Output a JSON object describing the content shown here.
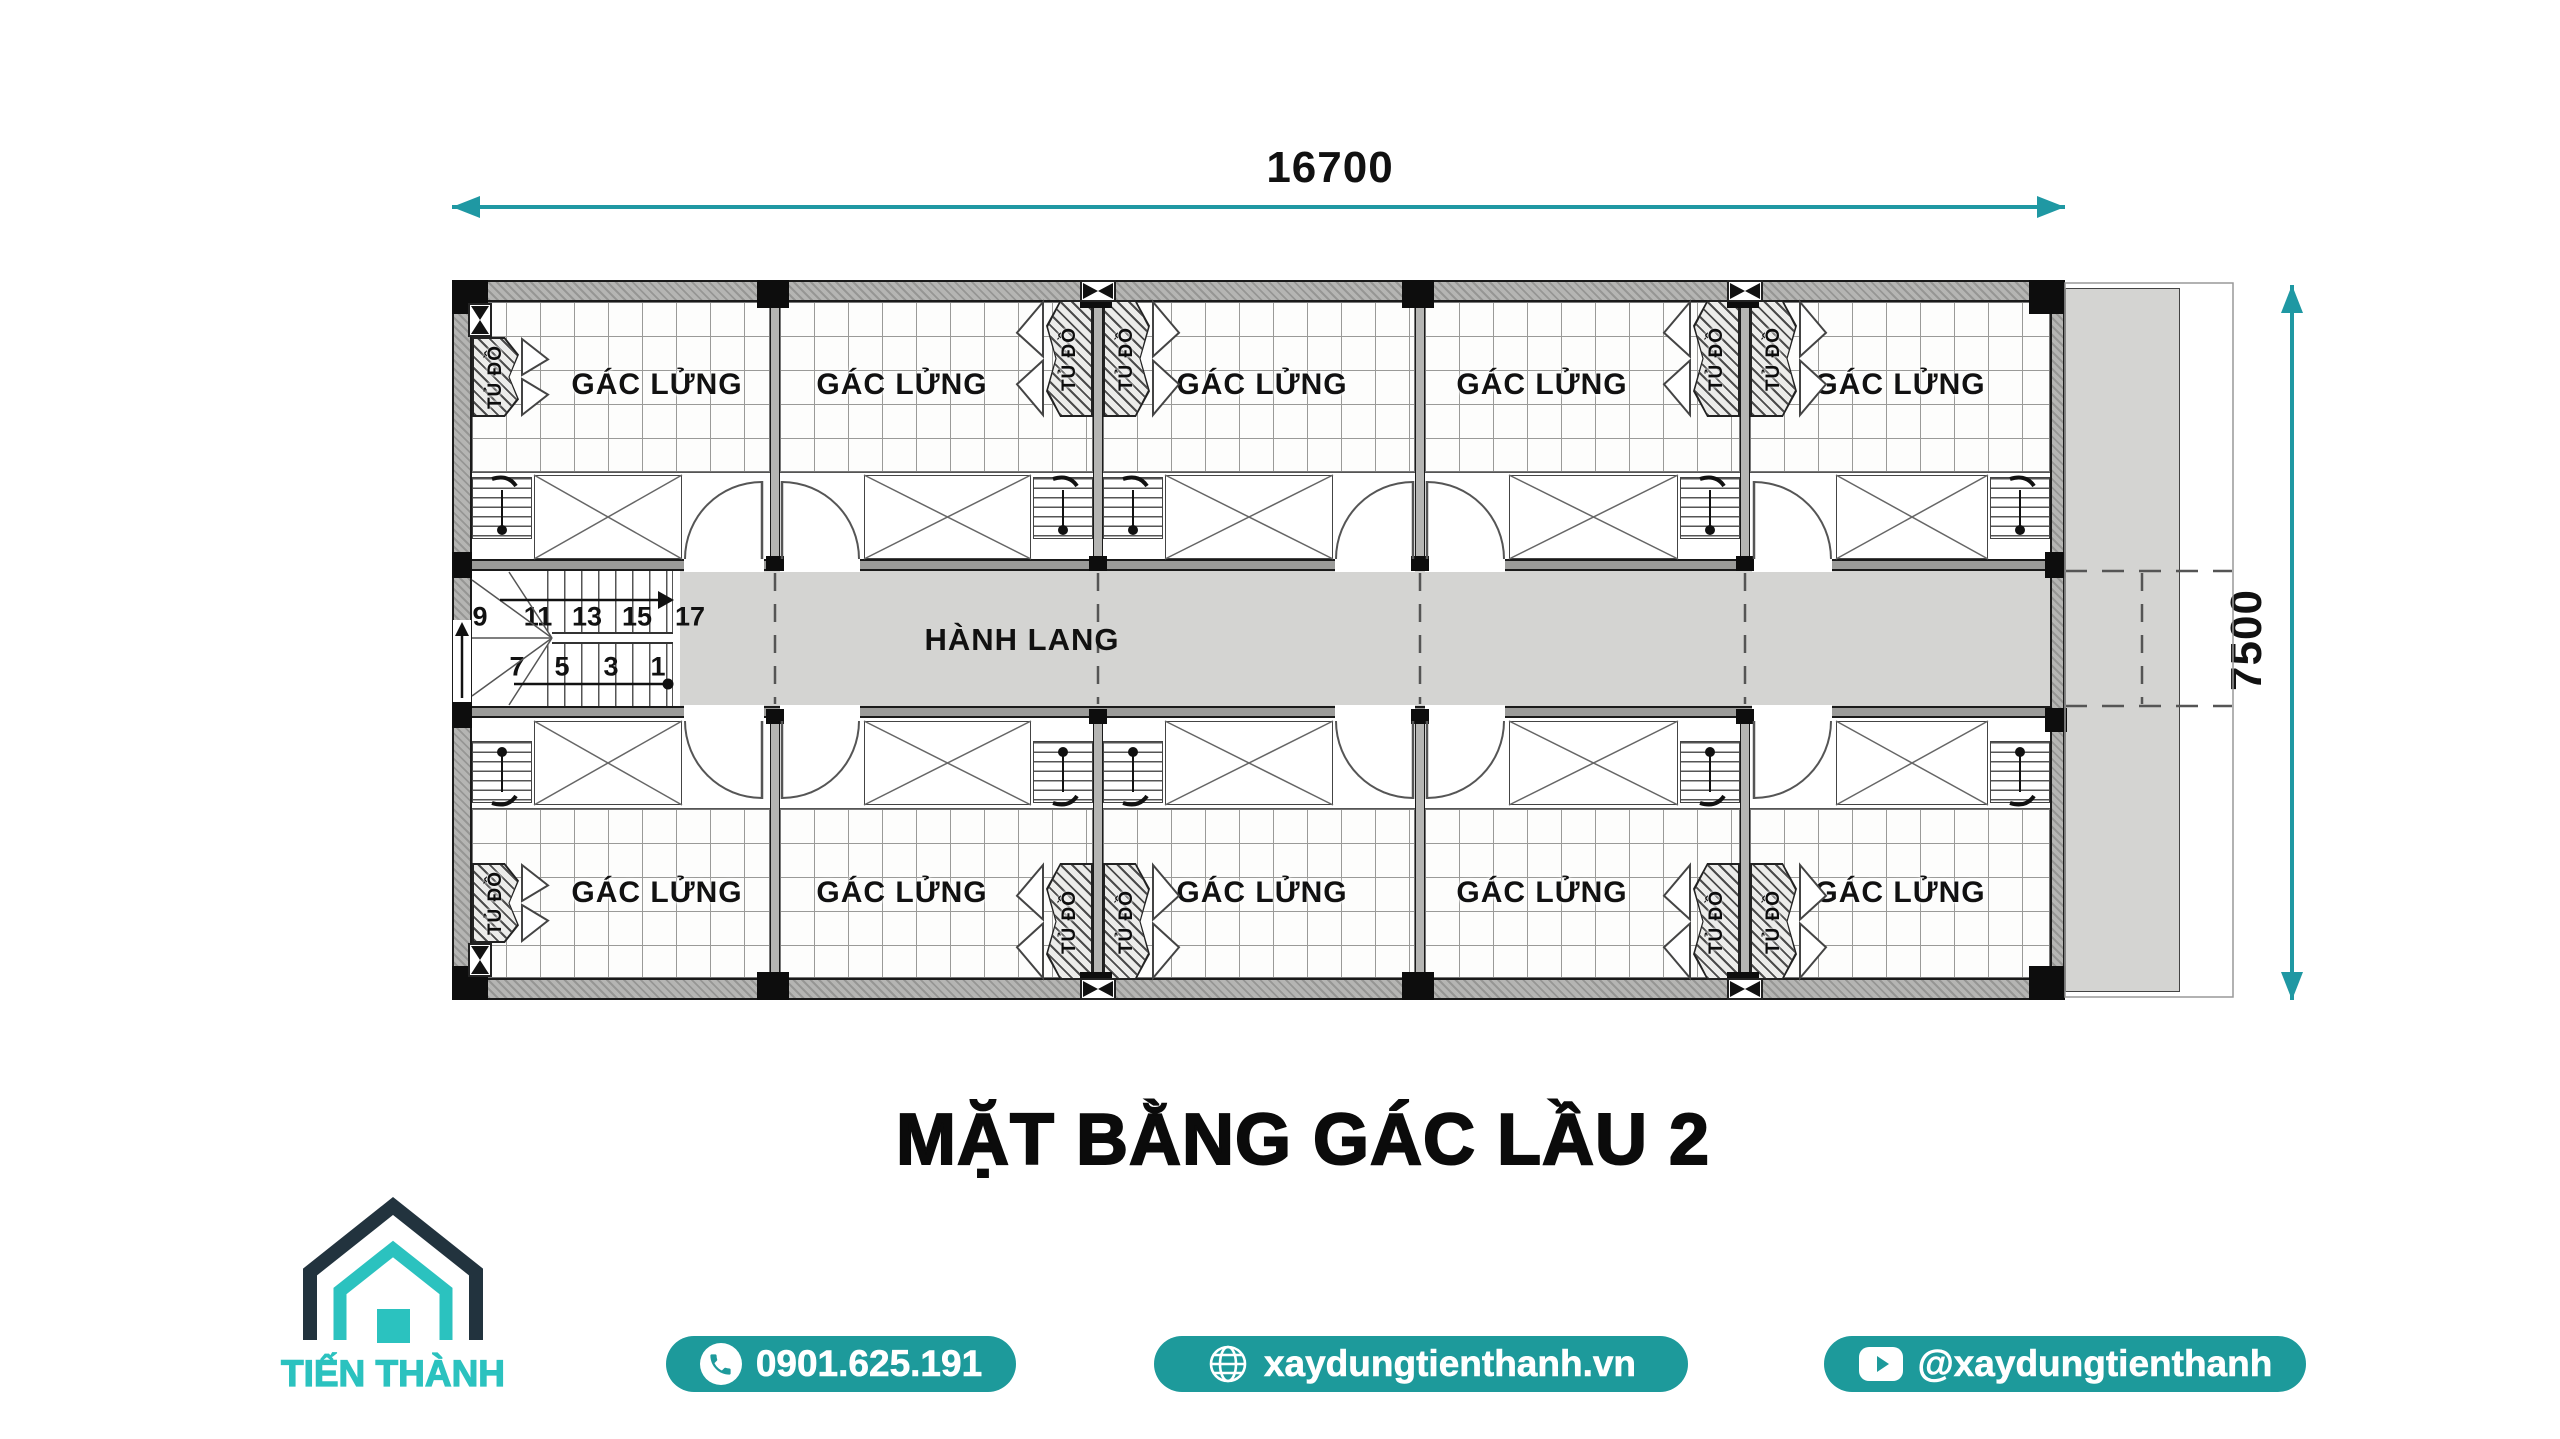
{
  "colors": {
    "teal_dim": "#1f98a3",
    "teal_pill": "#1d9a9b",
    "logo_navy": "#22333e",
    "logo_teal": "#2bc2bf",
    "corridor_gray": "#d4d4d2",
    "wall_gray": "#b5b5b3"
  },
  "dimensions": {
    "width_label": "16700",
    "height_label": "7500"
  },
  "title": "MẶT BẰNG GÁC LẦU 2",
  "plan": {
    "corridor_label": "HÀNH LANG",
    "rooms": {
      "top": [
        "GÁC LỬNG",
        "GÁC LỬNG",
        "GÁC LỬNG",
        "GÁC LỬNG",
        "GÁC LỬNG"
      ],
      "bottom": [
        "GÁC LỬNG",
        "GÁC LỬNG",
        "GÁC LỬNG",
        "GÁC LỬNG",
        "GÁC LỬNG"
      ]
    },
    "closets": {
      "top": [
        "TỦ ĐỒ",
        "TỦ ĐỒ",
        "TỦ ĐỒ",
        "TỦ ĐỒ",
        "TỦ ĐỒ"
      ],
      "bottom": [
        "TỦ ĐỒ",
        "TỦ ĐỒ",
        "TỦ ĐỒ",
        "TỦ ĐỒ",
        "TỦ ĐỒ"
      ]
    },
    "stair": {
      "top_numbers": [
        "9",
        "11",
        "13",
        "15",
        "17"
      ],
      "bottom_numbers": [
        "7",
        "5",
        "3",
        "1"
      ]
    }
  },
  "footer": {
    "brand": "TIẾN THÀNH",
    "phone": "0901.625.191",
    "website": "xaydungtienthanh.vn",
    "social": "@xaydungtienthanh"
  }
}
